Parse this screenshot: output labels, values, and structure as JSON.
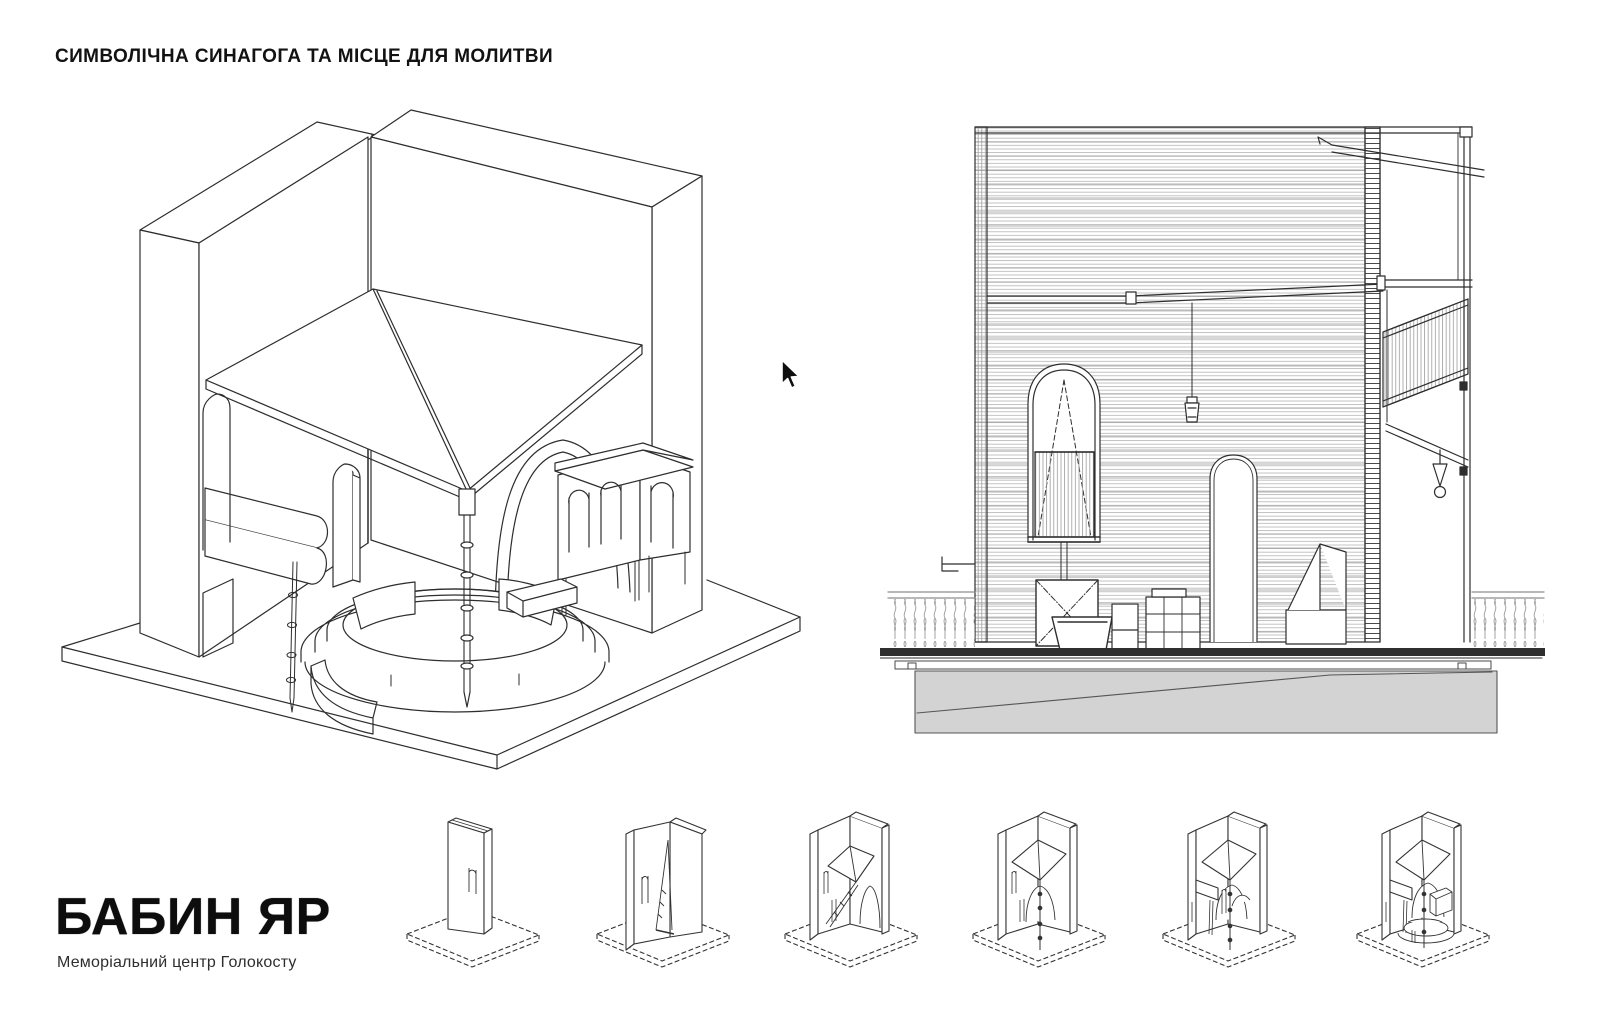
{
  "page": {
    "title": "СИМВОЛІЧНА СИНАГОГА ТА МІСЦЕ ДЛЯ МОЛИТВИ",
    "background_color": "#ffffff",
    "line_color": "#2e2e2e",
    "hatch_color": "#ababab",
    "ground_fill": "#d3d3d3"
  },
  "drawings": {
    "axonometric": {
      "name": "symbolic-synagogue-axonometric-view"
    },
    "section": {
      "name": "symbolic-synagogue-section-view"
    },
    "sequence": {
      "name": "transformation-sequence",
      "steps": [
        "closed-slab",
        "opening-leaf",
        "canopy-unfolding",
        "canopy-deployed-column",
        "furniture-unfolded",
        "complete-assembly"
      ]
    }
  },
  "cursor": {
    "icon": "arrow-cursor"
  },
  "branding": {
    "logo": "БАБИН ЯР",
    "subtitle": "Меморіальний центр Голокосту"
  }
}
